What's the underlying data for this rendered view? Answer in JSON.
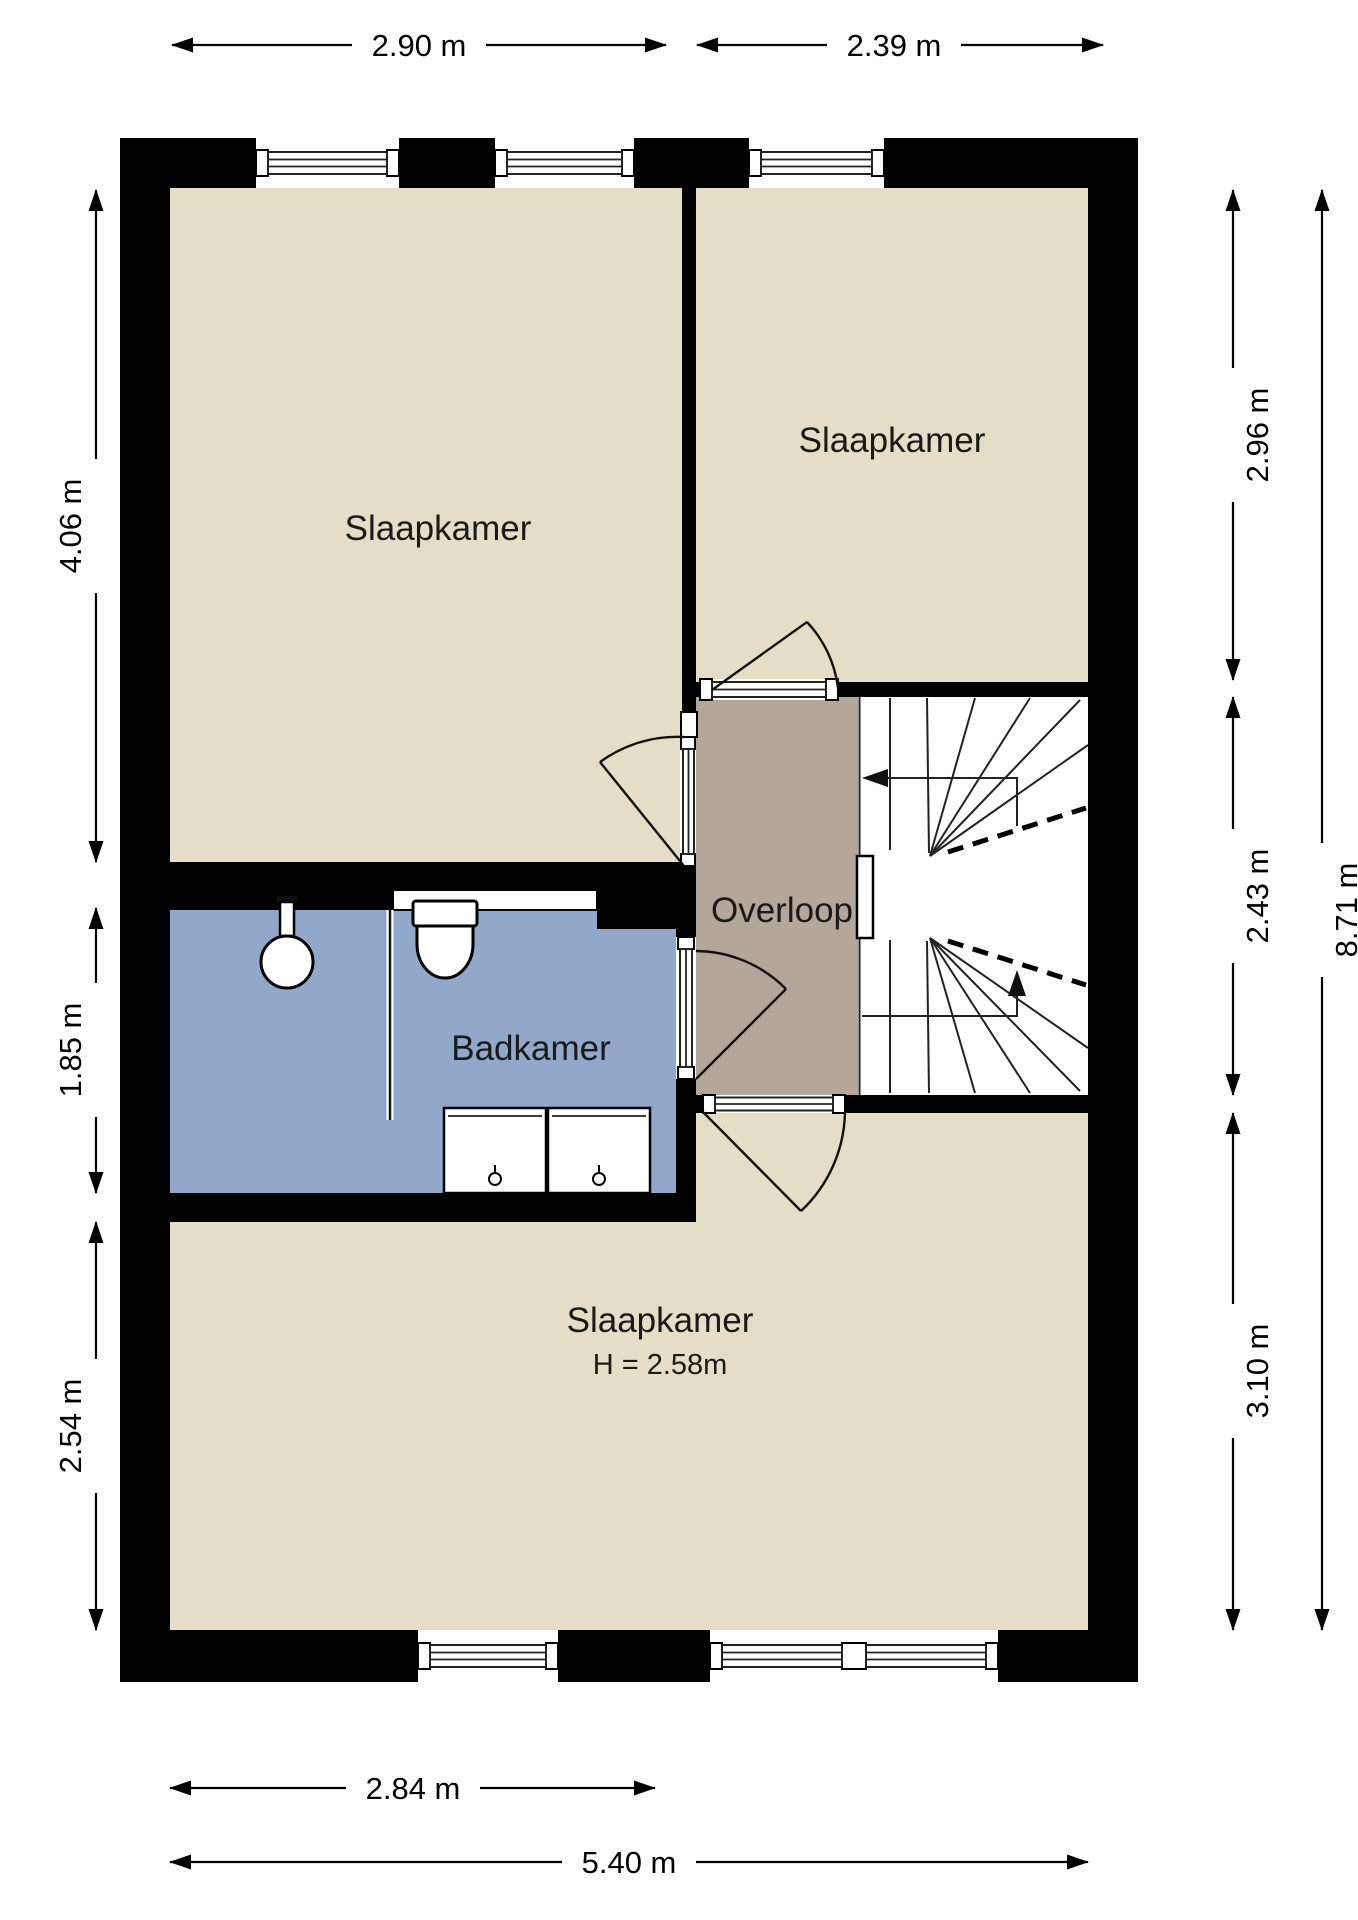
{
  "floorplan": {
    "rooms": [
      {
        "id": "slaapkamer-top-left",
        "label": "Slaapkamer"
      },
      {
        "id": "slaapkamer-top-right",
        "label": "Slaapkamer"
      },
      {
        "id": "overloop",
        "label": "Overloop"
      },
      {
        "id": "badkamer",
        "label": "Badkamer"
      },
      {
        "id": "slaapkamer-bottom",
        "label": "Slaapkamer",
        "height_note": "H = 2.58m"
      }
    ],
    "dimensions": {
      "top": [
        {
          "label": "2.90 m"
        },
        {
          "label": "2.39 m"
        }
      ],
      "bottom": [
        {
          "label": "2.84 m"
        },
        {
          "label": "5.40 m"
        }
      ],
      "left": [
        {
          "label": "4.06 m"
        },
        {
          "label": "1.85 m"
        },
        {
          "label": "2.54 m"
        }
      ],
      "right": [
        {
          "label": "2.96 m"
        },
        {
          "label": "2.43 m"
        },
        {
          "label": "3.10 m"
        },
        {
          "label": "8.71 m"
        }
      ]
    },
    "colors": {
      "wall": "#000000",
      "room_fill": "#e5dec6",
      "landing_fill": "#b4a698",
      "bathroom_fill": "#91a8ca",
      "background": "#ffffff"
    }
  }
}
